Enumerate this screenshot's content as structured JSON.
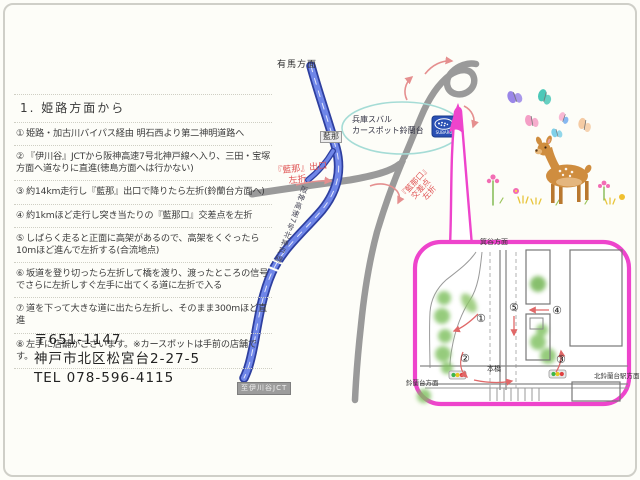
{
  "directions": {
    "title": "1. 姫路方面から",
    "steps": [
      {
        "num": "①",
        "text": "姫路・加古川バイパス経由 明石西より第二神明道路へ"
      },
      {
        "num": "②",
        "text": "『伊川谷』JCTから阪神高速7号北神戸線へ入り、三田・宝塚方面へ道なりに直進(徳島方面へは行かない)"
      },
      {
        "num": "③",
        "text": "約14km走行し『藍那』出口で降りたら左折(鈴蘭台方面へ)"
      },
      {
        "num": "④",
        "text": "約1kmほど走行し突き当たりの『藍那口』交差点を左折"
      },
      {
        "num": "⑤",
        "text": "しばらく走ると正面に高架があるので、高架をくぐったら10mほど進んで左折する(合流地点)"
      },
      {
        "num": "⑥",
        "text": "坂道を登り切ったら左折して橋を渡り、渡ったところの信号でさらに左折しすぐ左手に出てくる道に左折で入る"
      },
      {
        "num": "⑦",
        "text": "道を下って大きな道に出たら左折し、そのまま300mほど直進"
      },
      {
        "num": "⑧",
        "text": "左手に店舗がございます。※カースポットは手前の店舗です。"
      }
    ]
  },
  "address": {
    "postal": "〒651-1147",
    "line1": "神戸市北区松宮台2-27-5",
    "tel": "TEL 078-596-4115"
  },
  "map": {
    "label_arima": "有馬方面",
    "exit_box": "藍那",
    "exit_turn_line1": "『藍那』出口",
    "exit_turn_line2": "左折",
    "expressway": "阪神高速7号北神戸線",
    "crossing_line1": "『藍那口』",
    "crossing_line2": "交差点",
    "crossing_line3": "左折",
    "shop_line1": "兵庫スバル",
    "shop_line2": "カースポット鈴蘭台",
    "jct_badge": "至伊川谷JCT",
    "subaru_logo": "SUBARU"
  },
  "inset": {
    "top_label": "箕谷方面",
    "bridge_label": "本橋",
    "bottom_left_label": "鈴蘭台方面",
    "bottom_right_label": "北鈴蘭台駅方面",
    "numbers": [
      "①",
      "②",
      "③",
      "④",
      "⑤"
    ]
  },
  "colors": {
    "expressway_blue": "#4a63cf",
    "road_gray": "#9a9a9a",
    "arrow_salmon": "#e58f8f",
    "turn_red": "#e05555",
    "bubble_pink": "#ee44cc",
    "ellipse_teal": "#a5dcd6",
    "tree_green": "#7cbf5c",
    "deer_brown": "#cf8d3f"
  }
}
